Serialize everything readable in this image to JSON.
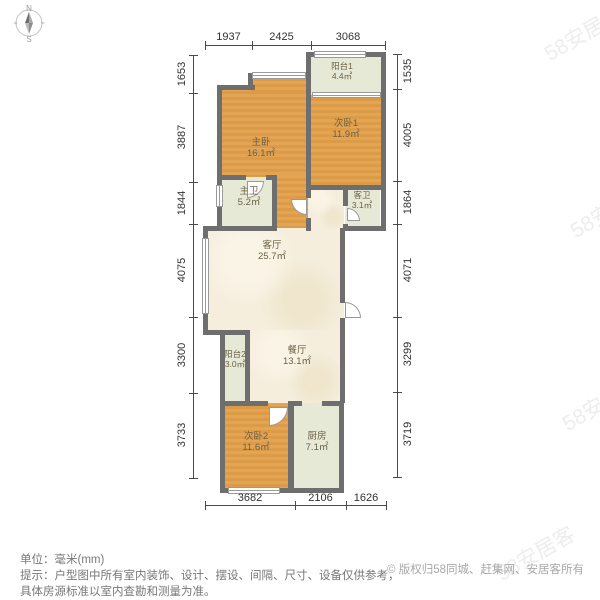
{
  "compass": {
    "north_label": "N",
    "south_label": "S"
  },
  "watermark": {
    "text": "58安居客"
  },
  "rooms": [
    {
      "id": "balcony1",
      "name": "阳台1",
      "area": "4.4㎡",
      "type": "balcony"
    },
    {
      "id": "bedroom1",
      "name": "次卧1",
      "area": "11.9㎡",
      "type": "bedroom"
    },
    {
      "id": "master-bedroom",
      "name": "主卧",
      "area": "16.1㎡",
      "type": "bedroom"
    },
    {
      "id": "master-bath",
      "name": "主卫",
      "area": "5.2㎡",
      "type": "bathroom"
    },
    {
      "id": "guest-bath",
      "name": "客卫",
      "area": "3.1㎡",
      "type": "bathroom"
    },
    {
      "id": "living-room",
      "name": "客厅",
      "area": "25.7㎡",
      "type": "living"
    },
    {
      "id": "balcony2",
      "name": "阳台2",
      "area": "3.0㎡",
      "type": "balcony"
    },
    {
      "id": "dining-room",
      "name": "餐厅",
      "area": "13.1㎡",
      "type": "dining"
    },
    {
      "id": "bedroom2",
      "name": "次卧2",
      "area": "11.6㎡",
      "type": "bedroom"
    },
    {
      "id": "kitchen",
      "name": "厨房",
      "area": "7.1㎡",
      "type": "kitchen"
    }
  ],
  "dimensions": {
    "top": [
      "1937",
      "2425",
      "3068"
    ],
    "left": [
      "1653",
      "3887",
      "1844",
      "4075",
      "3300",
      "3733"
    ],
    "right": [
      "1535",
      "4005",
      "1864",
      "4071",
      "3299",
      "3719"
    ],
    "bottom": [
      "3682",
      "2106",
      "1626"
    ]
  },
  "footer": {
    "unit_line": "单位：毫米(mm)",
    "tip_line1": "提示：户型图中所有室内装饰、设计、摆设、间隔、尺寸、设备仅供参考，",
    "tip_line2": "具体房源标准以室内查勘和测量为准。",
    "copyright": "© 版权归58同城、赶集网、安居客所有"
  },
  "colors": {
    "wall": "#6e6e6e",
    "bedroom_fill": "#e0a050",
    "living_fill": "#f5eedd",
    "balcony_bath_fill": "#e6e9d6",
    "dimension_text": "#333333",
    "footer_text": "#777777",
    "copyright_text": "#a8a8a8"
  }
}
